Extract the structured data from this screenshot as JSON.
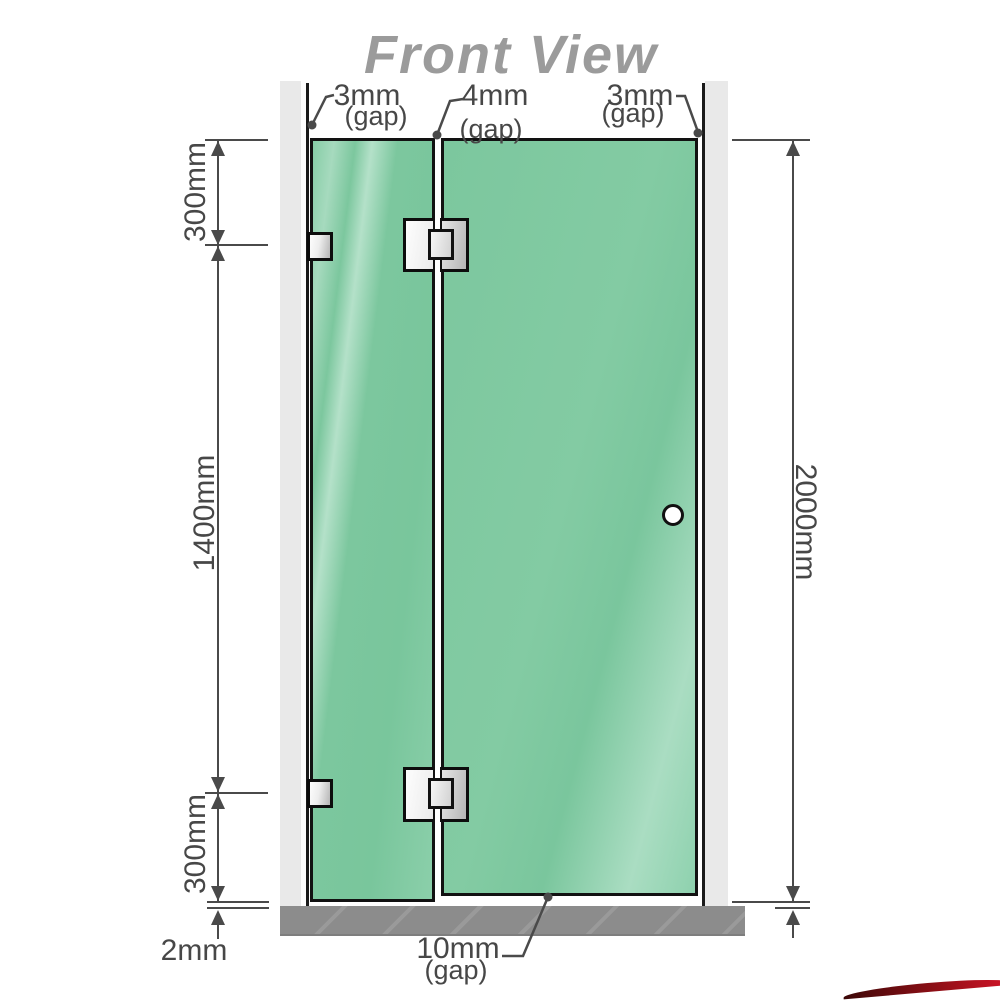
{
  "title": "Front View",
  "annotations": {
    "gap_top_left": {
      "value": "3mm",
      "note": "(gap)"
    },
    "gap_top_middle": {
      "value": "4mm",
      "note": "(gap)"
    },
    "gap_top_right": {
      "value": "3mm",
      "note": "(gap)"
    },
    "gap_bottom": {
      "value": "10mm",
      "note": "(gap)"
    }
  },
  "dimensions": {
    "left_top": "300mm",
    "left_middle": "1400mm",
    "left_bottom": "300mm",
    "bottom_left_gap": "2mm",
    "right_total": "2000mm"
  },
  "colors": {
    "glass_green": "#7cc79e",
    "glass_highlight": "#aaddc2",
    "wall_gray": "#e9e9e9",
    "floor_gray": "#8c8c8c",
    "dimension_gray": "#4a4a4a",
    "title_gray": "#9b9b9b",
    "outline_black": "#121212",
    "corner_red": "#d41428"
  }
}
